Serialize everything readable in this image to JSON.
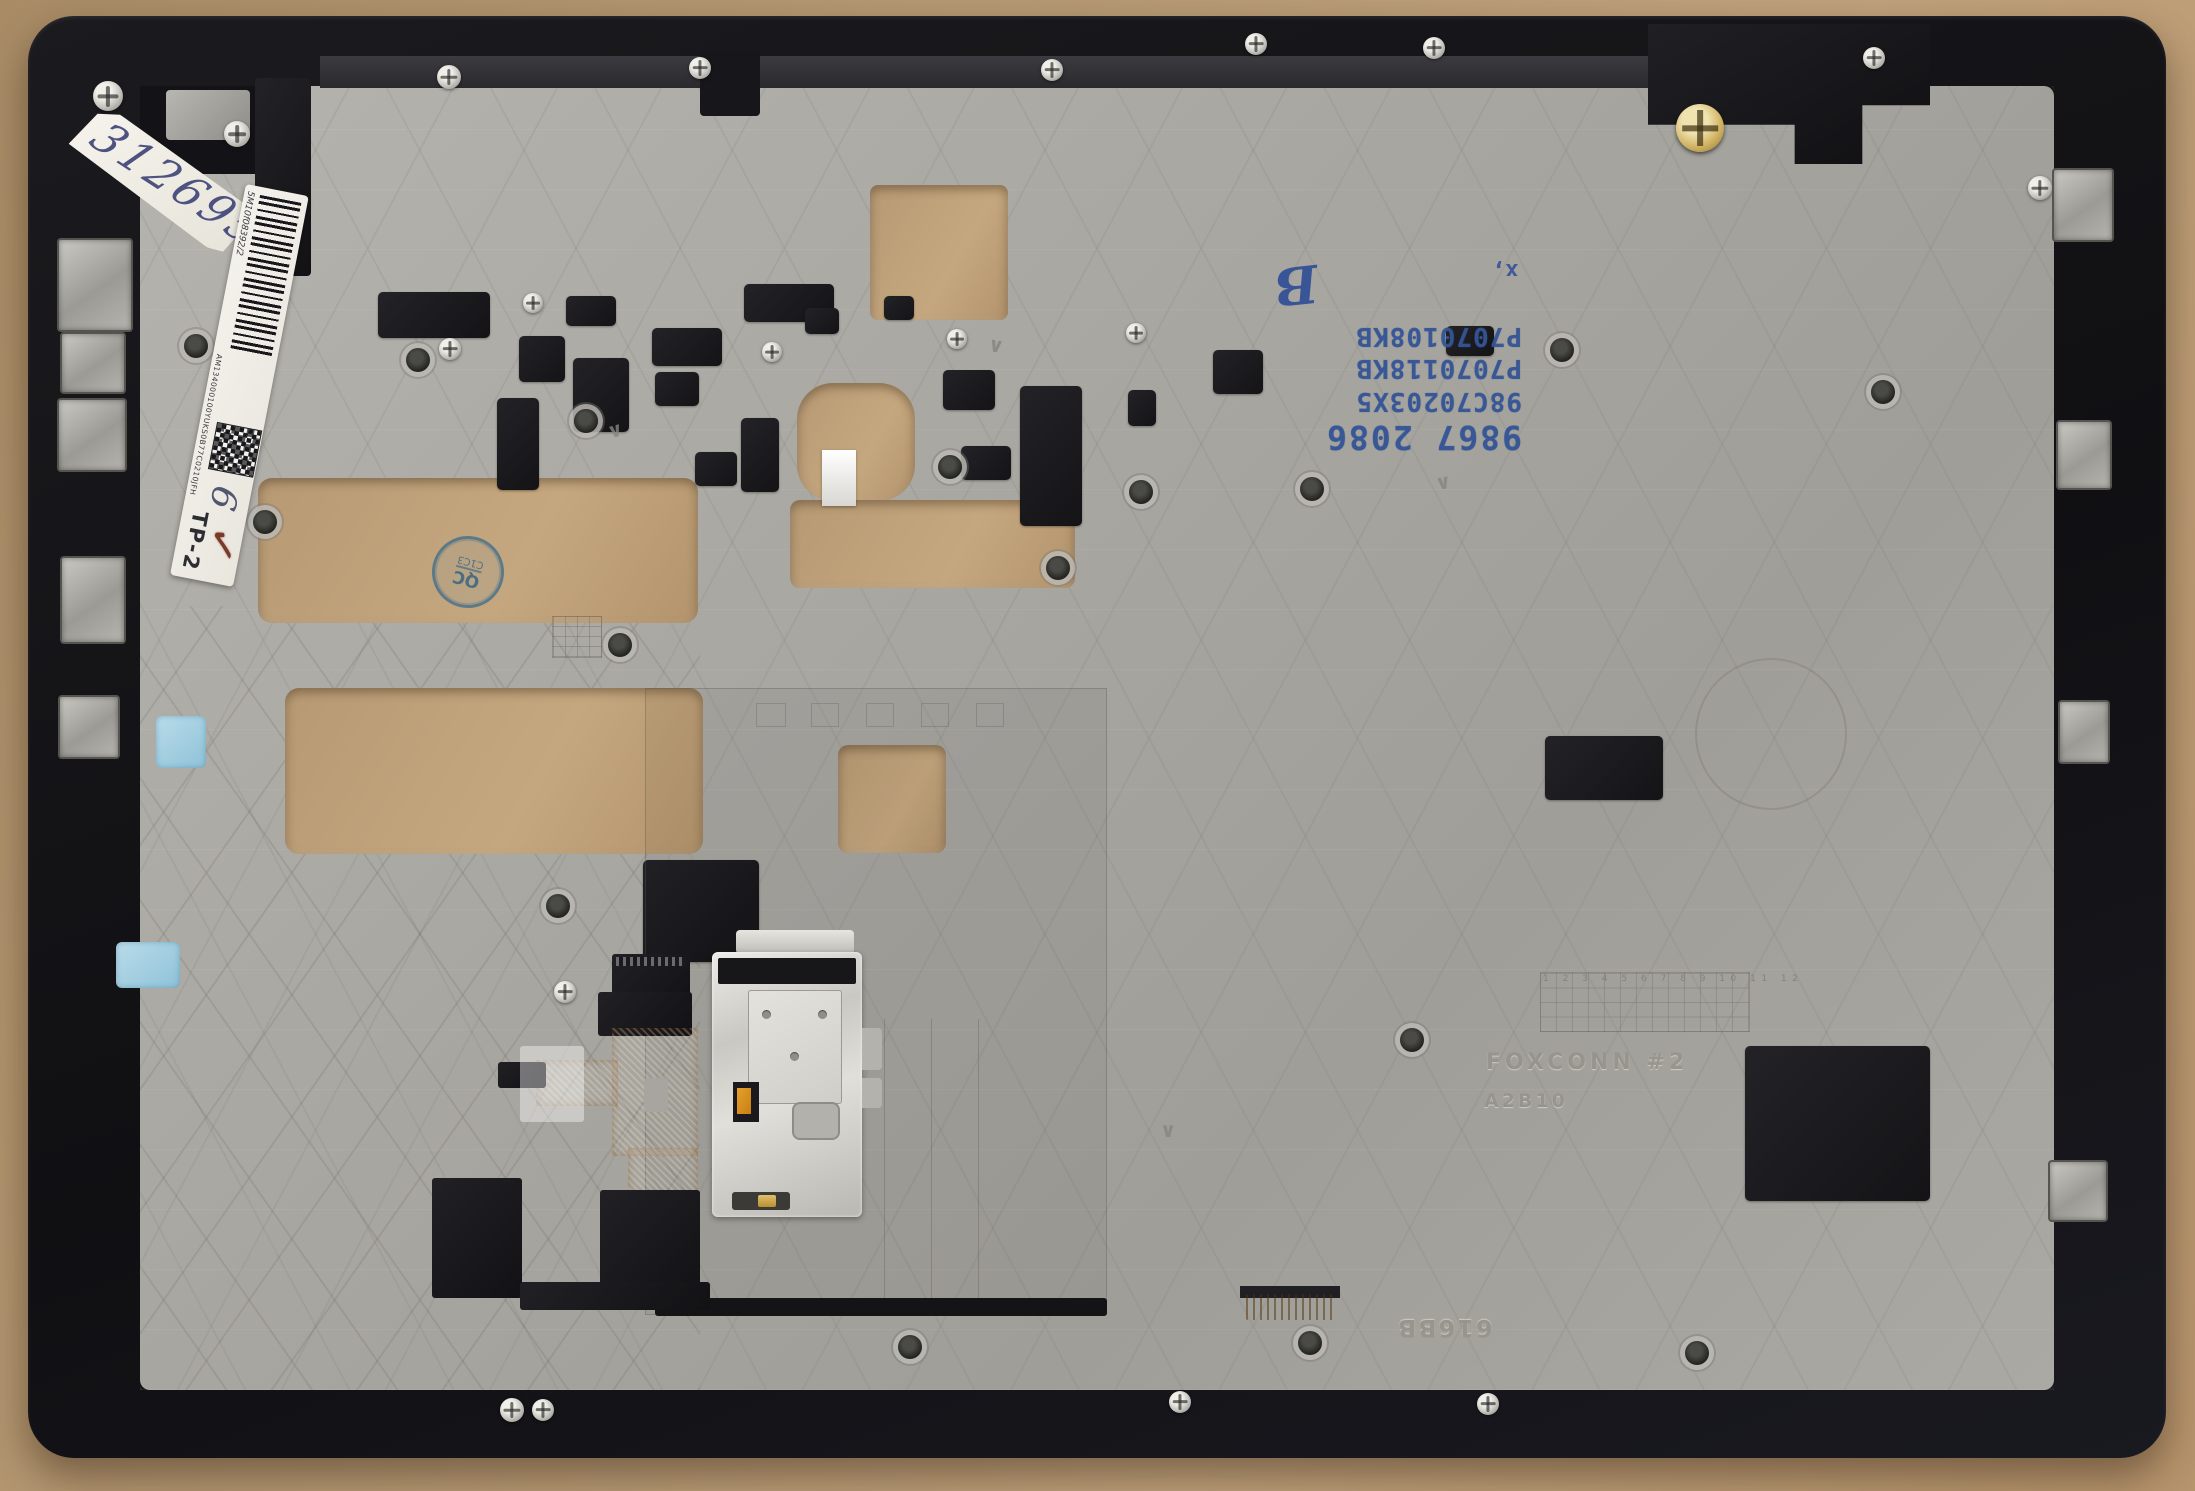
{
  "scene": {
    "description": "Laptop palmrest top-cover assembly (inner side) photographed on a tan desk",
    "colors": {
      "desk_tan": "#b59872",
      "frame_black": "#141417",
      "panel_magnesium": "#aaa8a2",
      "cable_orange": "#d8961f",
      "foam_blue": "#9ccadd",
      "ink_blue": "#3c5e97",
      "check_red": "#7a3a28"
    }
  },
  "labels": {
    "handwritten_tag": {
      "text": "312695"
    },
    "barcode_label": {
      "serial_top": "5M10f08392/2",
      "serial_mid": "AM134000100YUKS0B77C0210JFH",
      "handwritten_digit": "6",
      "tp_mark": "TP-2",
      "checkmark": "✓"
    },
    "qc_stamp": {
      "line1": "QC",
      "line2": "C1C3"
    },
    "blue_stamp": {
      "lines": [
        "P7070108KB",
        "P7070118KB",
        "98C70203X5",
        "9867 2086"
      ],
      "handwritten": "B",
      "mark": "x,"
    },
    "engraved": {
      "vendor": "FOXCONN #2",
      "rev": "A2B10",
      "mold": "616BB",
      "date_grid_numbers": "1 2 3 4 5 6 7 8 9 10 11 12"
    }
  }
}
